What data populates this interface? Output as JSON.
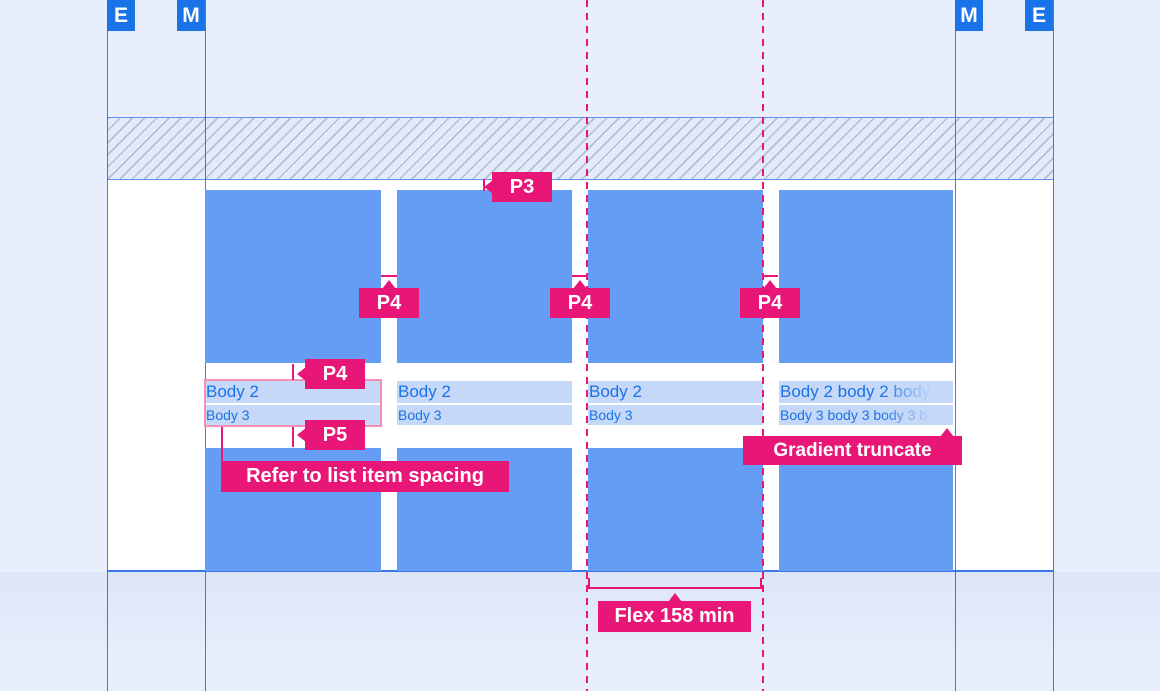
{
  "palette": {
    "background": "#e8eefb",
    "keyline_blue": "#1a73e8",
    "card_blue": "#669df4",
    "highlight_bar_blue": "#c6d8f7",
    "text_blue": "#1a73e8",
    "annotation_pink": "#e81777",
    "box_pink": "#f48fb6",
    "content_white": "#ffffff"
  },
  "markers": {
    "left_edge": "E",
    "left_margin": "M",
    "right_margin": "M",
    "right_edge": "E"
  },
  "cards": [
    {
      "body2": "Body 2",
      "body3": "Body 3"
    },
    {
      "body2": "Body 2",
      "body3": "Body 3"
    },
    {
      "body2": "Body 2",
      "body3": "Body 3"
    },
    {
      "body2": "Body 2 body 2 body 2",
      "body3": "Body 3 body 3 body 3 bo"
    }
  ],
  "annotations": {
    "top_padding": "P3",
    "gutter_1": "P4",
    "gutter_2": "P4",
    "gutter_3": "P4",
    "item_top": "P4",
    "item_bottom": "P5",
    "list_note": "Refer to list item spacing",
    "truncate_note": "Gradient truncate",
    "flex_note": "Flex 158 min"
  }
}
